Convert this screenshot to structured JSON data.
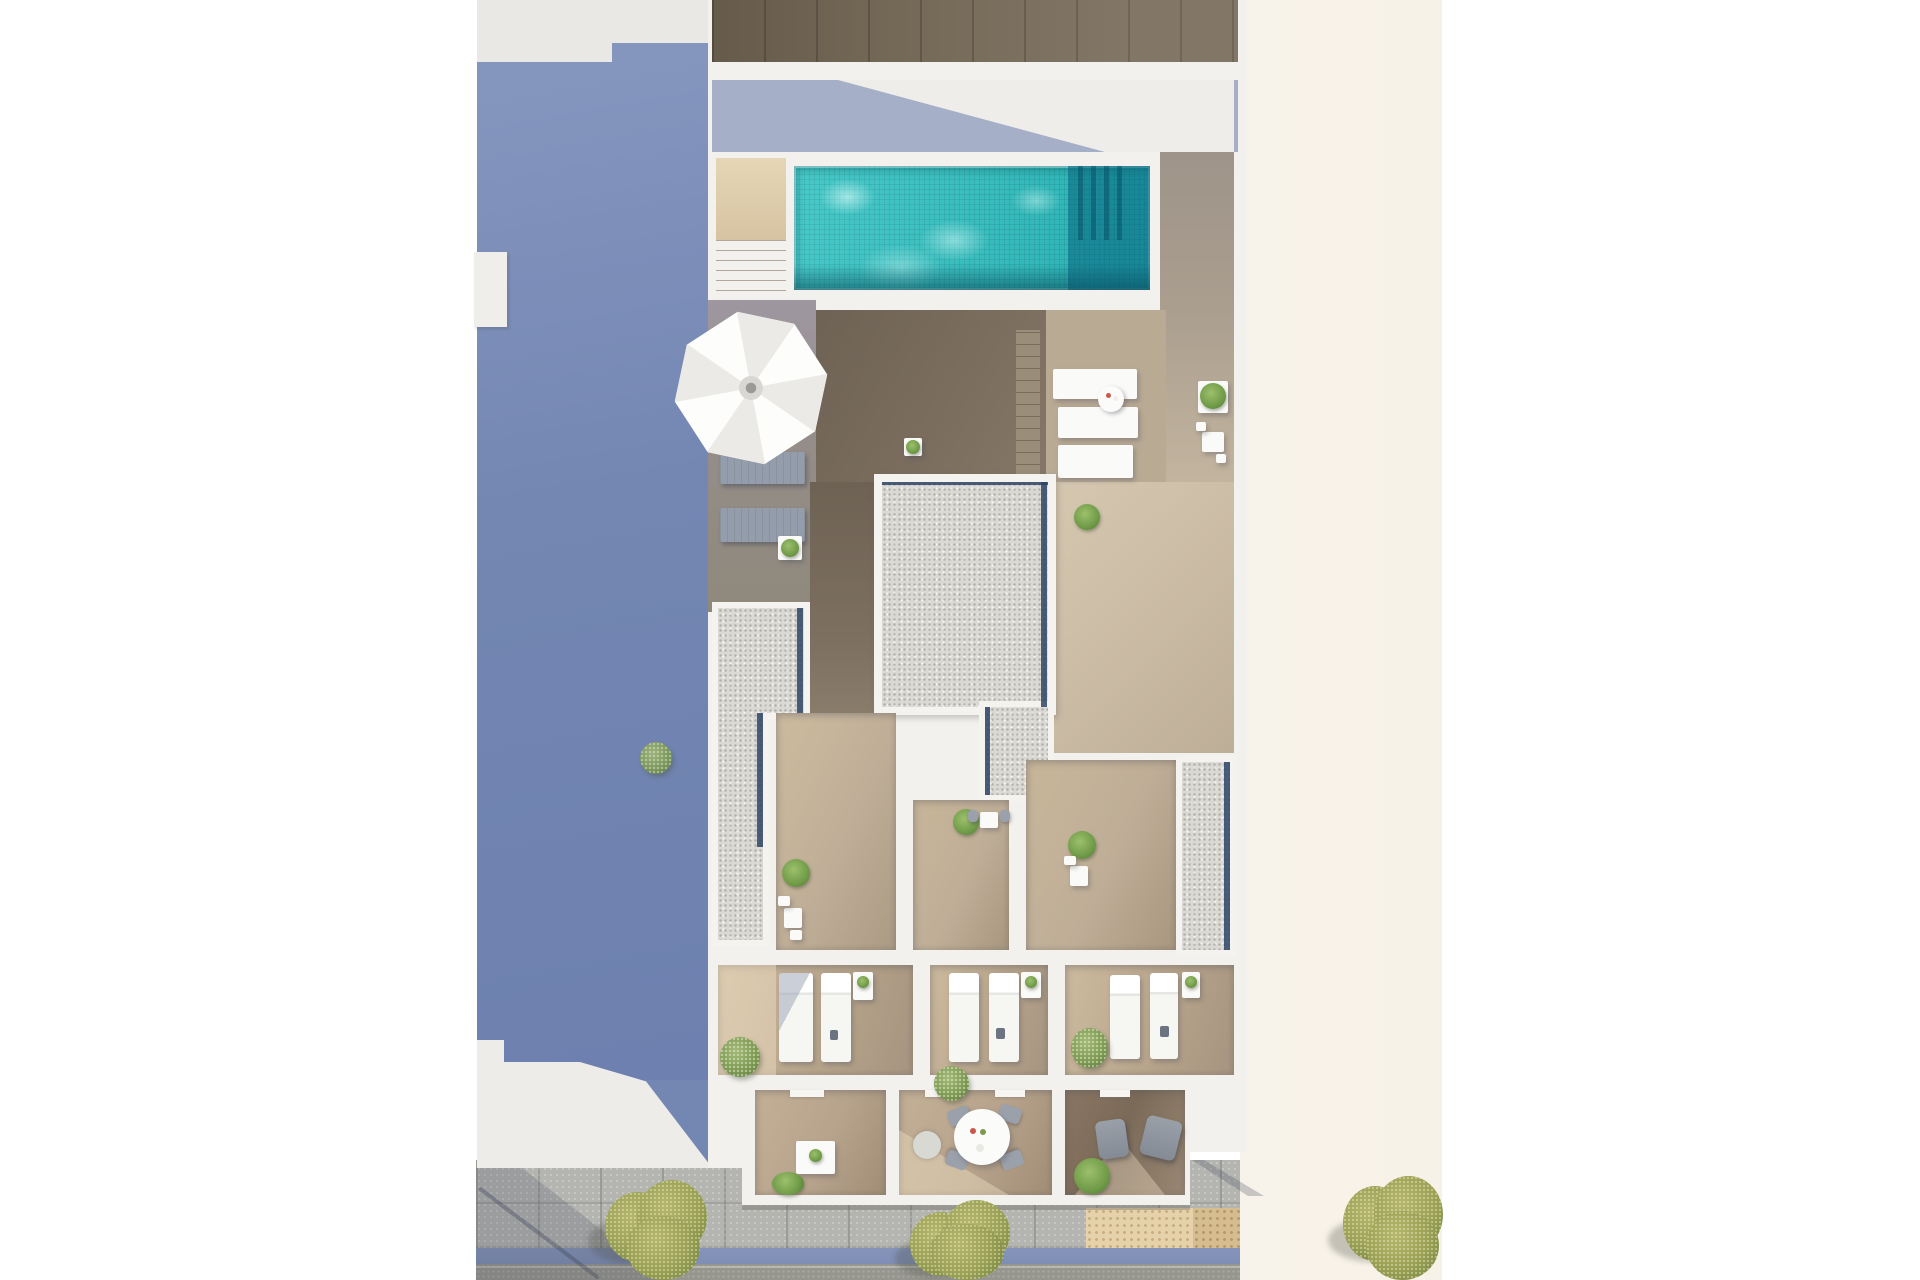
{
  "scene": {
    "type": "architectural-aerial-render",
    "description": "Top-down 3D rendering of a residential building rooftop: swimming pool with mosaic water, access stair, white parasol, sun deck, gravel flat-roof sections with dark drainage gutters, three private terraces with white sun loungers and plants, three lower balconies with outdoor furniture, and a street with stone sidewalk, tactile paving, blue curb line, asphalt road and three olive-green trees. A large slate-blue cast shadow covers the neighbouring plot on the left; a cream party wall strip runs along the right.",
    "palette": {
      "wall": "#f2f1ed",
      "wall_grey": "#e9e8e4",
      "cream": "#f8f3ea",
      "shadow_blue": "#7487b3",
      "shadow_strip": "#a6afc8",
      "wood_dark": "#746856",
      "deck_lit": "#ccbda6",
      "deck_mid": "#b9aa94",
      "deck_shadow": "#95897b",
      "terrace_wood": "#bfae97",
      "balcony_wood": "#b7a38c",
      "gravel": "#dad9d4",
      "gutter": "#2e4566",
      "pool_water": "#2fc2c1",
      "pool_deep": "#0f7e97",
      "stairs": "#d9c7a7",
      "lounger": "#f5f4f1",
      "furn_grey": "#939dab",
      "pave": "#b4b4b0",
      "curb": "#7e8eb5",
      "road": "#96968f",
      "tactile": "#e6d2aa",
      "tree": "#a2a45c",
      "bush": "#7d9a52"
    },
    "elements": {
      "swimming_pool": 1,
      "pool_stair": 1,
      "parasol": 1,
      "parasol_segments": 8,
      "grey_deck_loungers": 2,
      "white_slatted_benches": 3,
      "white_sun_loungers": 6,
      "gravel_roof_sections": 4,
      "terraces": 3,
      "balconies": 3,
      "round_dining_table_chairs": 4,
      "armchairs": 2,
      "potted_plants": 12,
      "street_trees": 3,
      "tactile_paving_strips": 2,
      "stair_treads": 6
    }
  }
}
